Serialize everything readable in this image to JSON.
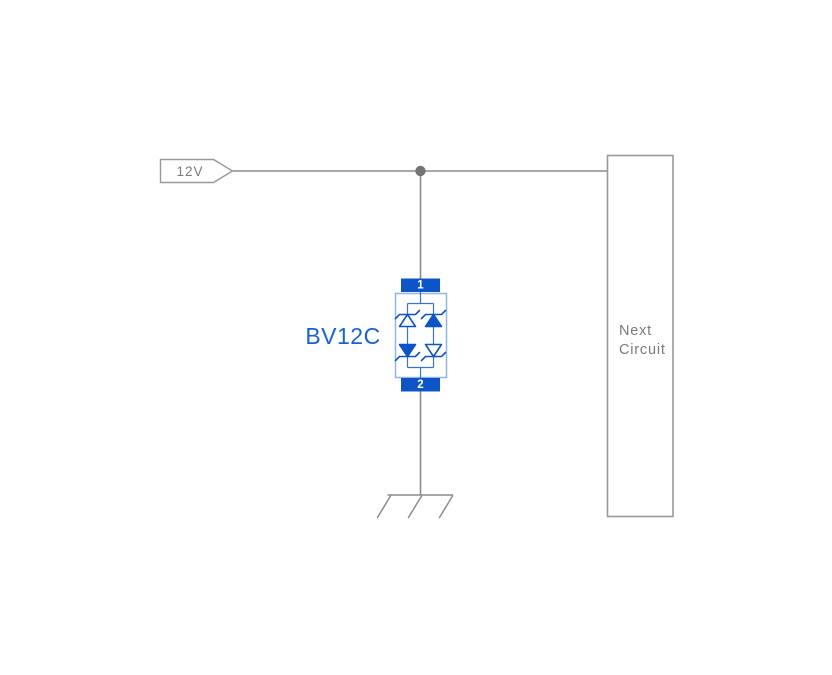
{
  "labels": {
    "supply_net": "12V"
  },
  "component": {
    "designator": "BV12C",
    "pin_top": "1",
    "pin_bottom": "2",
    "symbol": "bidirectional-tvs-diode"
  },
  "next_circuit": {
    "line1": "Next",
    "line2": "Circuit"
  },
  "symbols": {
    "power_tag": "net-label-flag",
    "junction": "junction-dot",
    "protection_device": "bidirectional-tvs-diode",
    "ground": "chassis-ground"
  },
  "colors": {
    "background": "#ffffff",
    "wire_gray": "#8c8c8c",
    "junction_gray": "#757575",
    "outline_gray": "#999999",
    "label_gray": "#7a7a7a",
    "component_blue": "#0d55c6",
    "component_border_blue": "#8fb6e4",
    "inner_wire_blue": "#3b74c9",
    "designator_blue": "#1763d2"
  }
}
